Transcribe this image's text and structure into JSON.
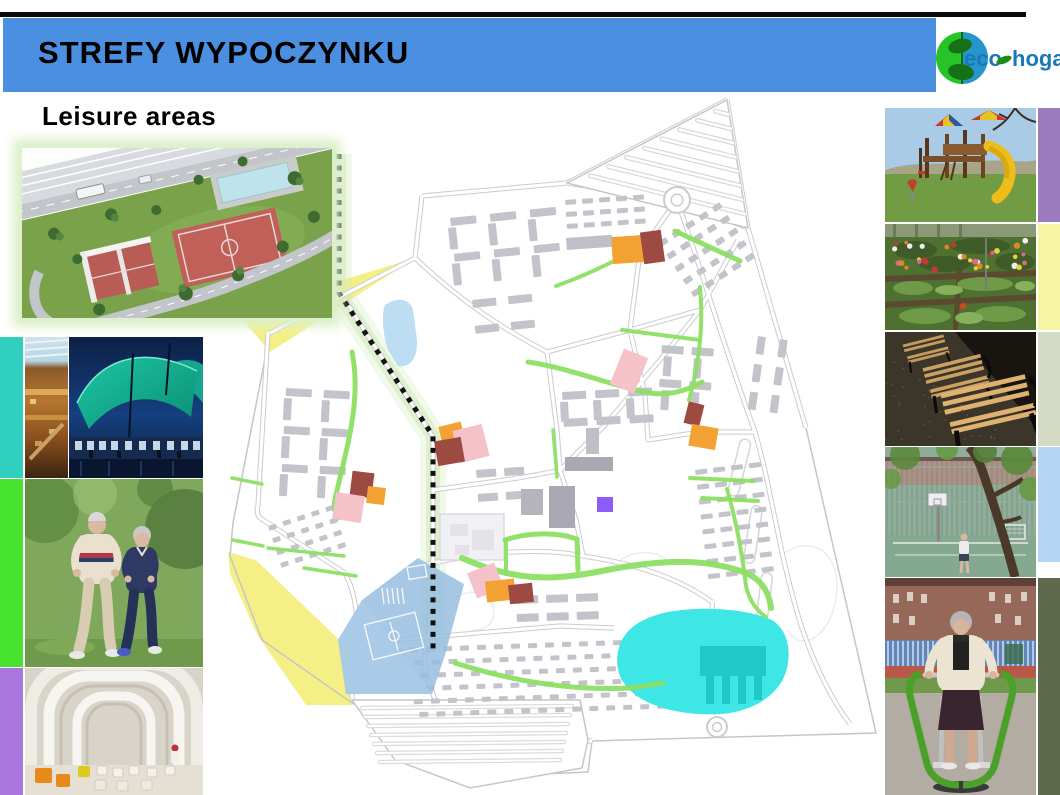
{
  "header": {
    "title": "STREFY WYPOCZYNKU",
    "subtitle": "Leisure areas"
  },
  "logo": {
    "eco": "eco",
    "hogar": "hogar"
  },
  "colors": {
    "header_blue": "#4a8fe0",
    "teal_strip": "#30cfc0",
    "green_strip": "#46e22e",
    "purple_strip": "#a878e0",
    "right_purple": "#9c7bbe",
    "right_yellow": "#f6f6a2",
    "right_olive": "#d4dac6",
    "right_blue": "#b5d5f2",
    "right_darkolive": "#5e6a4b",
    "map_yellow": "#f5f086",
    "pond_blue": "#bdddf3",
    "sports_blue": "#97bedf",
    "sports_blue2": "#aacbe8",
    "lake_cyan": "#3fe6e6",
    "lake_pier": "#1fc9c9",
    "purple_sq": "#8b5cf6",
    "marker_orange": "#f2a233",
    "marker_red": "#9c4a42",
    "marker_pink": "#f6c2ca",
    "green_path": "#8cdf63",
    "green_glow": "#cdeab5",
    "building": "#c3c3cb",
    "building_dark": "#a9a9b3",
    "road": "#cccccc",
    "boundary": "#c6c6c6",
    "dots": "#111111",
    "logo_green": "#27c427",
    "logo_blue": "#2695cc",
    "logo_text": "#1879b8",
    "logo_leaf": "#1d8c1d"
  },
  "photos": {
    "inset": "sports-complex-aerial-render",
    "left": [
      "shopping-mall-interior",
      "tented-leisure-building",
      "seniors-jogging",
      "modern-white-interior"
    ],
    "right": [
      "playground",
      "community-garden",
      "park-benches",
      "sports-court",
      "outdoor-exercise-machine"
    ]
  },
  "map": {
    "boundary": "M 727,100 L 748,228 L 806,428 L 876,733 L 592,741 L 588,772 L 495,776 L 455,743 L 352,703 L 262,640 L 230,556 L 233,523 L 270,333 L 415,258 L 422,196 L 567,183 Z",
    "roads": [
      "M 727,100 L 567,183",
      "M 727,100 L 748,228",
      "M 567,183 L 677,200 L 748,228",
      "M 748,228 L 806,428",
      "M 677,200 C 700,265 725,350 755,432 C 772,490 778,550 800,622 C 815,668 832,700 850,724",
      "M 567,183 L 422,196",
      "M 422,196 L 415,258",
      "M 415,258 L 270,333",
      "M 268,332 L 258,505 C 256,513 258,517 263,520 L 345,573",
      "M 345,300 L 433,437",
      "M 433,437 L 433,560 C 433,600 428,638 424,664",
      "M 415,258 C 470,310 515,335 547,352",
      "M 547,352 L 557,430 L 560,470",
      "M 433,490 C 490,482 530,477 560,470",
      "M 560,470 L 605,425 L 660,360 L 700,310 L 738,240",
      "M 677,200 L 640,252",
      "M 640,252 L 630,330 L 645,395",
      "M 630,330 L 700,310",
      "M 547,352 L 630,330",
      "M 645,395 L 648,440 L 700,432 L 755,432",
      "M 560,470 L 576,520 L 583,556",
      "M 424,565 C 480,552 540,547 583,556 C 645,565 685,582 712,602",
      "M 712,602 C 716,650 716,695 717,715",
      "M 382,641 L 560,626 L 614,628",
      "M 345,573 C 360,602 358,632 352,660 L 352,700",
      "M 424,664 C 430,690 442,720 455,743",
      "M 455,743 L 592,741"
    ],
    "zones": [
      {
        "name": "yellow-wedge-north",
        "color": "map_yellow",
        "d": "M 415,258 L 236,312 L 270,352 Z"
      },
      {
        "name": "yellow-band-southwest",
        "color": "map_yellow",
        "d": "M 228,552 L 256,560 L 352,652 L 355,705 L 306,705 L 258,636 L 230,574 Z"
      },
      {
        "name": "pond",
        "color": "pond_blue",
        "d": "M 385,305 C 398,296 410,299 413,310 L 417,340 C 418,358 410,368 398,366 L 388,350 C 383,335 381,314 385,305 Z"
      },
      {
        "name": "sports-area",
        "color": "sports_blue",
        "d": "M 418,558 L 464,584 L 445,655 L 432,694 L 346,694 L 338,640 L 362,600 Z"
      },
      {
        "name": "sports-area-light",
        "color": "sports_blue2",
        "d": "M 362,600 L 432,694 L 346,694 L 338,640 Z"
      },
      {
        "name": "lake",
        "color": "lake_cyan",
        "d": "M 618,652 C 622,630 640,618 668,612 C 700,606 745,608 772,620 C 788,630 792,652 786,672 C 778,696 752,712 720,714 C 685,716 650,708 632,692 C 620,682 615,668 618,652 Z"
      },
      {
        "name": "lake-pier",
        "color": "lake_pier",
        "d": "M 700,646 L 766,646 L 766,676 L 700,676 Z M 706,676 L 714,676 L 714,704 L 706,704 Z M 722,676 L 730,676 L 730,704 L 722,704 Z M 738,676 L 746,676 L 746,704 L 738,704 Z M 754,676 L 762,676 L 762,700 L 754,700 Z"
      }
    ],
    "greens": [
      {
        "d": "M 352,352 C 362,400 346,450 336,495 C 333,505 334,512 338,518",
        "w": 5
      },
      {
        "d": "M 528,362 C 570,368 612,386 650,393 C 670,396 688,390 702,382",
        "w": 5
      },
      {
        "d": "M 700,287 C 704,330 698,368 689,400",
        "w": 4
      },
      {
        "d": "M 622,330 L 700,340",
        "w": 4
      },
      {
        "d": "M 675,231 L 740,261",
        "w": 5
      },
      {
        "d": "M 612,262 C 588,274 570,281 556,286",
        "w": 4
      },
      {
        "d": "M 553,430 L 557,477",
        "w": 3.5
      },
      {
        "d": "M 462,558 C 520,584 560,579 602,571 C 652,561 702,556 746,573 C 762,580 769,592 771,608",
        "w": 6
      },
      {
        "d": "M 505,540 C 532,531 560,533 577,539 L 578,570",
        "w": 5
      },
      {
        "d": "M 506,541 L 506,574",
        "w": 4
      },
      {
        "d": "M 455,663 C 512,681 572,691 630,688 L 663,683",
        "w": 5
      },
      {
        "d": "M 690,478 L 753,481",
        "w": 4
      },
      {
        "d": "M 702,498 L 758,501",
        "w": 4
      },
      {
        "d": "M 727,489 C 736,520 742,552 746,586 C 749,600 756,610 766,617",
        "w": 4
      },
      {
        "d": "M 268,548 L 344,556",
        "w": 3.5
      },
      {
        "d": "M 304,568 L 356,576",
        "w": 3.5
      },
      {
        "d": "M 232,478 L 262,484",
        "w": 3.5
      },
      {
        "d": "M 233,540 L 263,546",
        "w": 3.5
      }
    ],
    "markers": [
      {
        "x": 612,
        "y": 236,
        "w": 33,
        "h": 27,
        "rot": -4,
        "color": "marker_orange"
      },
      {
        "x": 642,
        "y": 231,
        "w": 21,
        "h": 32,
        "rot": -8,
        "color": "marker_red"
      },
      {
        "x": 616,
        "y": 352,
        "w": 26,
        "h": 38,
        "rot": 22,
        "color": "marker_pink"
      },
      {
        "x": 686,
        "y": 403,
        "w": 16,
        "h": 22,
        "rot": 14,
        "color": "marker_red"
      },
      {
        "x": 690,
        "y": 426,
        "w": 27,
        "h": 22,
        "rot": 10,
        "color": "marker_orange"
      },
      {
        "x": 440,
        "y": 424,
        "w": 23,
        "h": 17,
        "rot": -14,
        "color": "marker_orange"
      },
      {
        "x": 456,
        "y": 427,
        "w": 30,
        "h": 33,
        "rot": -14,
        "color": "marker_pink"
      },
      {
        "x": 436,
        "y": 439,
        "w": 27,
        "h": 25,
        "rot": -10,
        "color": "marker_red"
      },
      {
        "x": 351,
        "y": 472,
        "w": 22,
        "h": 25,
        "rot": 7,
        "color": "marker_red"
      },
      {
        "x": 367,
        "y": 487,
        "w": 18,
        "h": 17,
        "rot": 7,
        "color": "marker_orange"
      },
      {
        "x": 334,
        "y": 494,
        "w": 29,
        "h": 27,
        "rot": 9,
        "color": "marker_pink"
      },
      {
        "x": 471,
        "y": 567,
        "w": 29,
        "h": 27,
        "rot": -22,
        "color": "marker_pink"
      },
      {
        "x": 486,
        "y": 580,
        "w": 29,
        "h": 21,
        "rot": -6,
        "color": "marker_orange"
      },
      {
        "x": 509,
        "y": 584,
        "w": 24,
        "h": 19,
        "rot": -6,
        "color": "marker_red"
      },
      {
        "x": 597,
        "y": 497,
        "w": 16,
        "h": 15,
        "rot": 0,
        "color": "purple_sq"
      }
    ],
    "clusters": [
      {
        "x": 450,
        "y": 218,
        "cols": 3,
        "rows": 2,
        "w": 26,
        "h": 8,
        "gx": 40,
        "gy": 36,
        "rot": -6
      },
      {
        "x": 448,
        "y": 228,
        "cols": 3,
        "rows": 2,
        "w": 8,
        "h": 22,
        "gx": 40,
        "gy": 36,
        "rot": -6
      },
      {
        "x": 472,
        "y": 300,
        "cols": 2,
        "rows": 2,
        "w": 24,
        "h": 8,
        "gx": 36,
        "gy": 26,
        "rot": -6
      },
      {
        "x": 565,
        "y": 200,
        "cols": 5,
        "rows": 3,
        "w": 11,
        "h": 5,
        "gx": 17,
        "gy": 12,
        "rot": -4
      },
      {
        "x": 658,
        "y": 242,
        "cols": 5,
        "rows": 5,
        "w": 9,
        "h": 6,
        "gx": 16,
        "gy": 15,
        "rot": -33
      },
      {
        "x": 662,
        "y": 345,
        "cols": 2,
        "rows": 2,
        "w": 22,
        "h": 8,
        "gx": 30,
        "gy": 34,
        "rot": 4
      },
      {
        "x": 664,
        "y": 356,
        "cols": 2,
        "rows": 2,
        "w": 8,
        "h": 20,
        "gx": 30,
        "gy": 34,
        "rot": 4
      },
      {
        "x": 758,
        "y": 336,
        "cols": 2,
        "rows": 3,
        "w": 8,
        "h": 18,
        "gx": 22,
        "gy": 28,
        "rot": 8
      },
      {
        "x": 562,
        "y": 392,
        "cols": 3,
        "rows": 2,
        "w": 24,
        "h": 8,
        "gx": 33,
        "gy": 27,
        "rot": -3
      },
      {
        "x": 560,
        "y": 402,
        "cols": 3,
        "rows": 1,
        "w": 8,
        "h": 20,
        "gx": 33,
        "gy": 27,
        "rot": -3
      },
      {
        "x": 695,
        "y": 470,
        "cols": 4,
        "rows": 8,
        "w": 12,
        "h": 5,
        "gx": 18,
        "gy": 15,
        "rot": -7
      },
      {
        "x": 286,
        "y": 388,
        "cols": 2,
        "rows": 3,
        "w": 26,
        "h": 8,
        "gx": 38,
        "gy": 38,
        "rot": 3
      },
      {
        "x": 284,
        "y": 398,
        "cols": 2,
        "rows": 3,
        "w": 8,
        "h": 22,
        "gx": 38,
        "gy": 38,
        "rot": 3
      },
      {
        "x": 268,
        "y": 526,
        "cols": 5,
        "rows": 4,
        "w": 8,
        "h": 5,
        "gx": 15,
        "gy": 13,
        "rot": -18
      },
      {
        "x": 392,
        "y": 648,
        "cols": 16,
        "rows": 6,
        "w": 9,
        "h": 5,
        "gx": 17,
        "gy": 13,
        "rot": -2,
        "sx": 5
      },
      {
        "x": 516,
        "y": 596,
        "cols": 3,
        "rows": 2,
        "w": 22,
        "h": 8,
        "gx": 30,
        "gy": 18,
        "rot": -2
      },
      {
        "x": 476,
        "y": 470,
        "cols": 2,
        "rows": 2,
        "w": 20,
        "h": 8,
        "gx": 28,
        "gy": 24,
        "rot": -4
      }
    ],
    "bars": [
      {
        "x": 566,
        "y": 238,
        "w": 46,
        "h": 12,
        "rot": -4,
        "f": "#bfbfc7"
      },
      {
        "x": 565,
        "y": 457,
        "w": 48,
        "h": 14,
        "rot": 0,
        "f": "#a9a9b3"
      },
      {
        "x": 549,
        "y": 486,
        "w": 26,
        "h": 42,
        "rot": 0,
        "f": "#a9a9b3"
      },
      {
        "x": 521,
        "y": 489,
        "w": 22,
        "h": 26,
        "rot": 0,
        "f": "#b4b4bc"
      },
      {
        "x": 586,
        "y": 428,
        "w": 13,
        "h": 26,
        "rot": 0,
        "f": "#bfbfc7"
      },
      {
        "x": 440,
        "y": 514,
        "w": 64,
        "h": 46,
        "rot": 0,
        "f": "#f1f1f5",
        "s": "#d9d9df"
      },
      {
        "x": 450,
        "y": 524,
        "w": 18,
        "h": 12,
        "rot": 0,
        "f": "#e2e2e8"
      },
      {
        "x": 472,
        "y": 530,
        "w": 22,
        "h": 20,
        "rot": 0,
        "f": "#e2e2e8"
      },
      {
        "x": 455,
        "y": 545,
        "w": 14,
        "h": 10,
        "rot": 0,
        "f": "#e2e2e8"
      }
    ],
    "islands": [
      {
        "x": 741,
        "y": 438,
        "w": 11,
        "h": 58,
        "rot": 14
      },
      {
        "x": 752,
        "y": 505,
        "w": 11,
        "h": 58,
        "rot": 9
      },
      {
        "x": 762,
        "y": 572,
        "w": 11,
        "h": 52,
        "rot": 7
      }
    ],
    "roundabouts": [
      {
        "cx": 677,
        "cy": 200,
        "r": 13
      },
      {
        "cx": 717,
        "cy": 727,
        "r": 10
      }
    ],
    "contours": [
      "M 786,552 C 816,534 842,556 836,598 C 830,640 798,652 788,630",
      "M 455,598 C 470,588 486,592 492,604 C 498,618 488,632 472,630",
      "M 620,560 C 640,548 660,552 668,562"
    ],
    "dots_path": "M 339,154 L 339,293 L 433,436 L 433,650",
    "olive_dots": [
      [
        262,
        290
      ],
      [
        276,
        299
      ],
      [
        290,
        308
      ]
    ]
  }
}
